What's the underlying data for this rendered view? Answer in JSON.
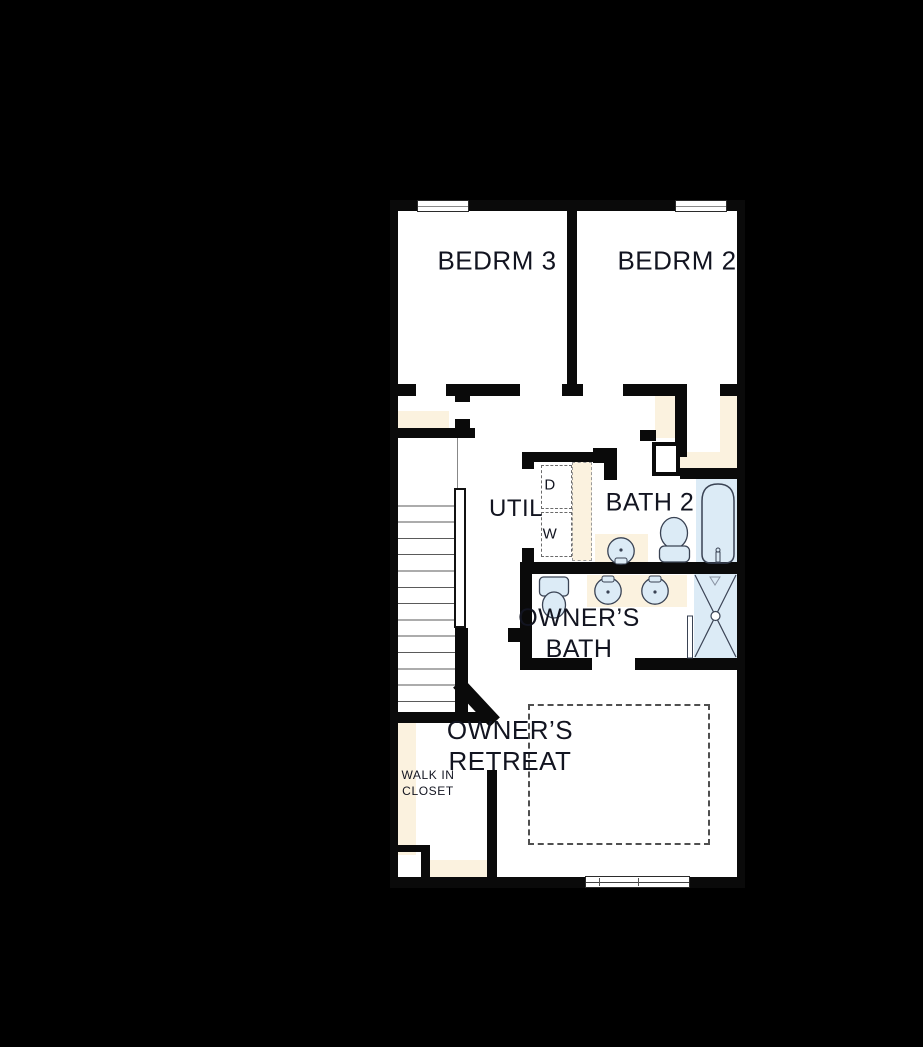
{
  "plan": {
    "type": "floor-plan",
    "labels": {
      "bedrm3": "BEDRM 3",
      "bedrm2": "BEDRM 2",
      "util": "UTIL",
      "bath2": "BATH 2",
      "owners_bath_line1": "OWNER’S",
      "owners_bath_line2": "BATH",
      "owners_retreat_line1": "OWNER’S",
      "owners_retreat_line2": "RETREAT",
      "walkin_line1": "WALK IN",
      "walkin_line2": "CLOSET",
      "dryer": "D",
      "washer": "W"
    },
    "colors": {
      "background": "#000000",
      "floor": "#ffffff",
      "wall": "#0a0a0a",
      "casework_tan": "#fbf2df",
      "fixture_blue": "#dcebf6",
      "label_text": "#121420",
      "dashed_line": "#6b6b6b"
    },
    "fixtures": [
      "stairs",
      "handrail",
      "stacked-washer-dryer",
      "bathtub",
      "toilet",
      "single-sink",
      "double-vanity",
      "walk-in-shower",
      "bed-dashed-outline",
      "closet-shelves",
      "windows"
    ]
  }
}
